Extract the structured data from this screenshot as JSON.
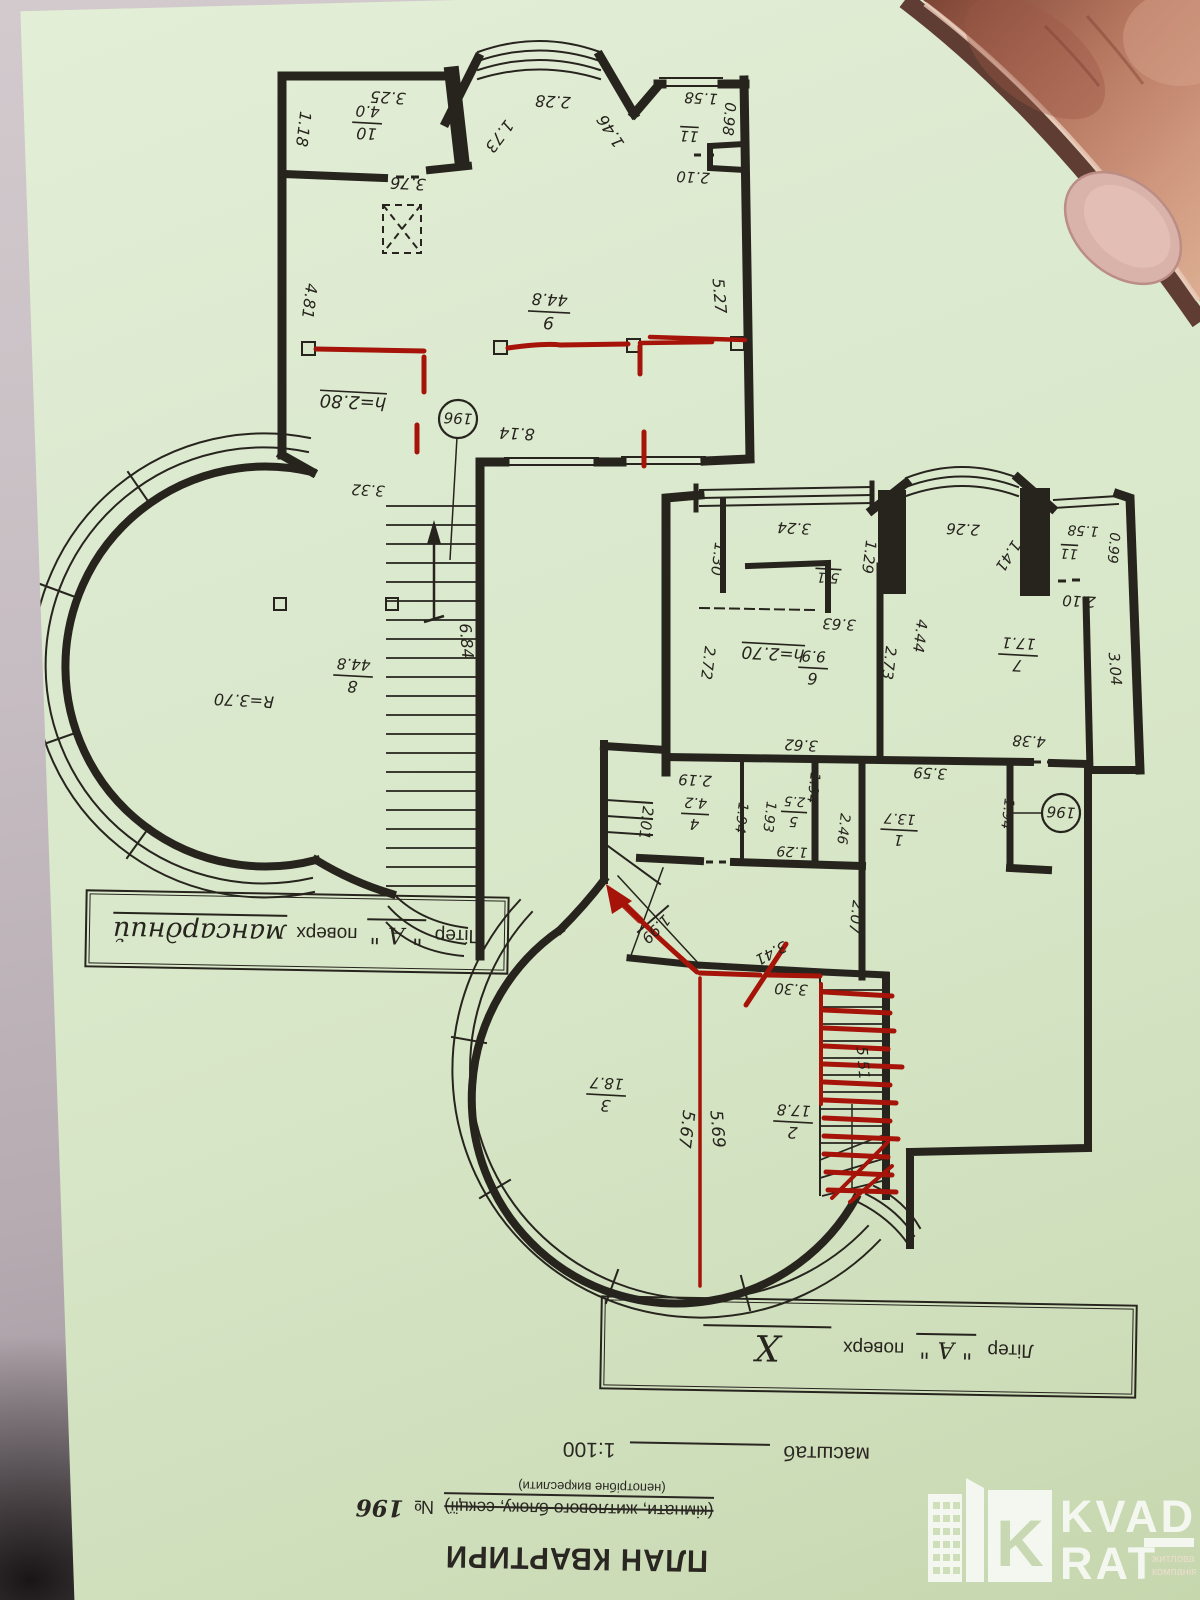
{
  "photo": {
    "paper_color": "#d9e7ca",
    "ink_color": "#27241e",
    "red_ink_color": "#a51309",
    "description": "green paper apartment floor plan photographed upside down, held by a finger at top right"
  },
  "title_block": {
    "title": "ПЛАН КВАРТИРИ",
    "unit_line": "(кімнати, житлового блоку, секції)",
    "unit_number_label": "№",
    "unit_number": "196",
    "note": "(непотрібне викреслити)",
    "scale_label": "масштаб",
    "scale_value": "1:100"
  },
  "captions": {
    "upper": {
      "prefix": "Літер",
      "letter": "\" А \"",
      "word": "поверх",
      "floor": "мансардний"
    },
    "lower": {
      "prefix": "Літер",
      "letter": "\" А \"",
      "word": "поверх",
      "floor": "X"
    }
  },
  "logo": {
    "letter": "K",
    "name_line1": "KVAD",
    "name_line2": "RAT",
    "tagline_line1": "житлова",
    "tagline_line2": "компанія"
  },
  "plans": {
    "upper": {
      "name": "мансардний поверх",
      "labels": [
        {
          "t": "3.25",
          "x": 388,
          "y": 97,
          "r": 183
        },
        {
          "t": "1.18",
          "x": 303,
          "y": 129,
          "r": 97
        },
        {
          "t": "3.76",
          "x": 408,
          "y": 183,
          "r": 183
        },
        {
          "t": "1.73",
          "x": 499,
          "y": 136,
          "r": 127
        },
        {
          "t": "2.28",
          "x": 553,
          "y": 101,
          "r": 183
        },
        {
          "t": "1.46",
          "x": 611,
          "y": 131,
          "r": 237
        },
        {
          "t": "1.58",
          "x": 701,
          "y": 98,
          "r": 183,
          "s": 15
        },
        {
          "t": "0.98",
          "x": 729,
          "y": 119,
          "r": 95,
          "s": 15
        },
        {
          "t": "11",
          "x": 689,
          "y": 136,
          "r": 183,
          "s": 15,
          "u": 1
        },
        {
          "t": "2.10",
          "x": 693,
          "y": 177,
          "r": 183,
          "s": 15
        },
        {
          "t": "4.81",
          "x": 309,
          "y": 301,
          "r": 97
        },
        {
          "t": "5.27",
          "x": 719,
          "y": 296,
          "r": 85
        },
        {
          "t": "8.14",
          "x": 517,
          "y": 433,
          "r": 183
        },
        {
          "t": "3.32",
          "x": 368,
          "y": 490,
          "r": 183,
          "s": 15
        },
        {
          "t": "6.84",
          "x": 466,
          "y": 641,
          "r": 85
        },
        {
          "t": "R=3.70",
          "x": 244,
          "y": 700,
          "r": 183
        },
        {
          "t": "h=2.80",
          "x": 353,
          "y": 401,
          "r": 183,
          "u": 1,
          "s": 18
        },
        {
          "t": "10",
          "t2": "4.0",
          "x": 367,
          "y": 124,
          "r": 183,
          "fr": 1
        },
        {
          "t": "9",
          "t2": "44.8",
          "x": 549,
          "y": 313,
          "r": 183,
          "fr": 1,
          "s": 17
        },
        {
          "t": "8",
          "t2": "44.8",
          "x": 353,
          "y": 677,
          "r": 183,
          "fr": 1
        },
        {
          "t": "196",
          "x": 458,
          "y": 419,
          "r": 183,
          "badge": 1,
          "s": 15
        }
      ]
    },
    "lower": {
      "name": "поверх X",
      "labels": [
        {
          "t": "1.30",
          "x": 718,
          "y": 559,
          "r": 97,
          "s": 15
        },
        {
          "t": "3.24",
          "x": 794,
          "y": 528,
          "r": 183,
          "s": 15
        },
        {
          "t": "1.29",
          "x": 869,
          "y": 557,
          "r": 97,
          "s": 15
        },
        {
          "t": "5.1",
          "x": 828,
          "y": 578,
          "r": 183,
          "s": 14,
          "u": 1
        },
        {
          "t": "2.26",
          "x": 963,
          "y": 529,
          "r": 183,
          "s": 15
        },
        {
          "t": "1.41",
          "x": 1008,
          "y": 556,
          "r": 123,
          "s": 15
        },
        {
          "t": "11",
          "x": 1069,
          "y": 554,
          "r": 183,
          "s": 14,
          "u": 1
        },
        {
          "t": "1.58",
          "x": 1083,
          "y": 531,
          "r": 183,
          "s": 14
        },
        {
          "t": "0.99",
          "x": 1114,
          "y": 548,
          "r": 95,
          "s": 14
        },
        {
          "t": "2.10",
          "x": 1079,
          "y": 601,
          "r": 183,
          "s": 15
        },
        {
          "t": "3.63",
          "x": 839,
          "y": 624,
          "r": 183,
          "s": 15
        },
        {
          "t": "h=2.70",
          "x": 773,
          "y": 653,
          "r": 183,
          "u": 1,
          "s": 17
        },
        {
          "t": "2.72",
          "x": 708,
          "y": 663,
          "r": 97,
          "s": 15
        },
        {
          "t": "2.73",
          "x": 889,
          "y": 663,
          "r": 97,
          "s": 15
        },
        {
          "t": "4.44",
          "x": 920,
          "y": 636,
          "r": 97,
          "s": 15
        },
        {
          "t": "3.04",
          "x": 1115,
          "y": 669,
          "r": 85,
          "s": 15
        },
        {
          "t": "3.62",
          "x": 801,
          "y": 745,
          "r": 183,
          "s": 15
        },
        {
          "t": "4.38",
          "x": 1029,
          "y": 741,
          "r": 183,
          "s": 15
        },
        {
          "t": "3.59",
          "x": 930,
          "y": 773,
          "r": 183,
          "s": 15
        },
        {
          "t": "2.19",
          "x": 695,
          "y": 780,
          "r": 183,
          "s": 15
        },
        {
          "t": "1.94",
          "x": 742,
          "y": 818,
          "r": 97,
          "s": 14
        },
        {
          "t": "1.93",
          "x": 770,
          "y": 817,
          "r": 97,
          "s": 14
        },
        {
          "t": "1.29",
          "x": 792,
          "y": 852,
          "r": 183,
          "s": 14
        },
        {
          "t": "1.94",
          "x": 814,
          "y": 788,
          "r": 97,
          "s": 14
        },
        {
          "t": "2.46",
          "x": 844,
          "y": 829,
          "r": 97,
          "s": 14
        },
        {
          "t": "1.94",
          "x": 1008,
          "y": 814,
          "r": 97,
          "s": 14
        },
        {
          "t": "2.01",
          "x": 646,
          "y": 823,
          "r": 97,
          "s": 15
        },
        {
          "t": "2.07",
          "x": 856,
          "y": 917,
          "r": 97,
          "s": 15
        },
        {
          "t": "1.99",
          "x": 656,
          "y": 929,
          "r": 135,
          "s": 15
        },
        {
          "t": "3.41",
          "x": 771,
          "y": 953,
          "r": 152,
          "s": 15
        },
        {
          "t": "3.30",
          "x": 791,
          "y": 989,
          "r": 183,
          "s": 15
        },
        {
          "t": "5.51",
          "x": 863,
          "y": 1063,
          "r": 85,
          "s": 15
        },
        {
          "t": "5.67",
          "x": 686,
          "y": 1129,
          "r": 97,
          "s": 17
        },
        {
          "t": "5.69",
          "x": 717,
          "y": 1129,
          "r": 85,
          "s": 17
        },
        {
          "t": "6",
          "t2": "9.9",
          "x": 813,
          "y": 669,
          "r": 183,
          "fr": 1,
          "s": 16
        },
        {
          "t": "7",
          "t2": "17.1",
          "x": 1018,
          "y": 656,
          "r": 183,
          "fr": 1,
          "s": 16
        },
        {
          "t": "4",
          "t2": "4.2",
          "x": 695,
          "y": 815,
          "r": 183,
          "fr": 1,
          "s": 15
        },
        {
          "t": "5",
          "t2": "2.5",
          "x": 794,
          "y": 813,
          "r": 183,
          "fr": 1,
          "s": 14
        },
        {
          "t": "1",
          "t2": "13.7",
          "x": 899,
          "y": 831,
          "r": 183,
          "fr": 1,
          "s": 15
        },
        {
          "t": "3",
          "t2": "18.7",
          "x": 606,
          "y": 1096,
          "r": 183,
          "fr": 1,
          "s": 16
        },
        {
          "t": "2",
          "t2": "17.8",
          "x": 793,
          "y": 1123,
          "r": 183,
          "fr": 1,
          "s": 16
        },
        {
          "t": "196",
          "x": 1061,
          "y": 813,
          "r": 183,
          "badge": 1,
          "s": 15
        }
      ]
    }
  }
}
